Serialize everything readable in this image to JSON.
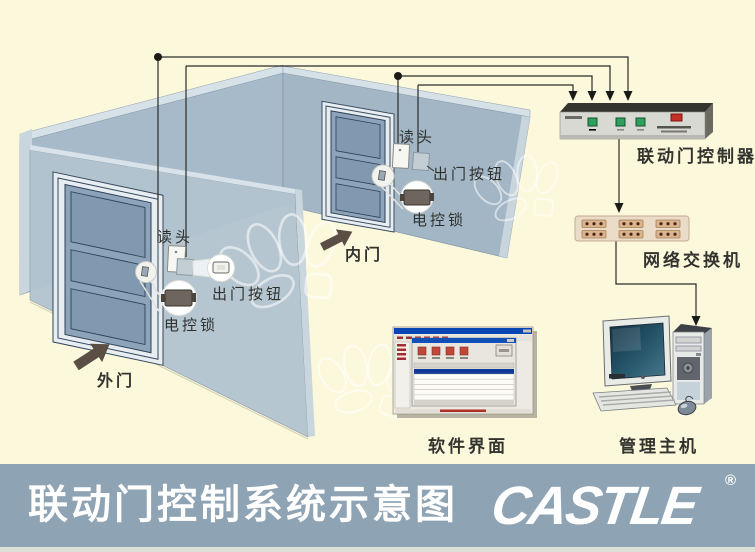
{
  "scene": {
    "outer_door": {
      "label": "外门",
      "reader": "读头",
      "exit_button": "出门按钮",
      "lock": "电控锁"
    },
    "inner_door": {
      "label": "内门",
      "reader": "读头",
      "exit_button": "出门按钮",
      "lock": "电控锁"
    },
    "equipment": {
      "controller": "联动门控制器",
      "network_switch": "网络交换机",
      "software_ui": "软件界面",
      "management_host": "管理主机"
    }
  },
  "banner": {
    "title": "联动门控制系统示意图",
    "logo_text": "CASTLE",
    "registered_mark": "®",
    "banner_color": "#8EA3B3"
  },
  "colors": {
    "background": "#FBF8DC",
    "wall": "#A5B8C7",
    "partition": "#B2C4D0",
    "door": "#8CA3BA",
    "wire": "#2B2B28",
    "arrow": "#5A4E45",
    "controller_body": "#D9D9D3",
    "controller_led": "#2FA05C",
    "switch_body": "#EBDCC8",
    "software_titlebar": "#0A46B4"
  }
}
